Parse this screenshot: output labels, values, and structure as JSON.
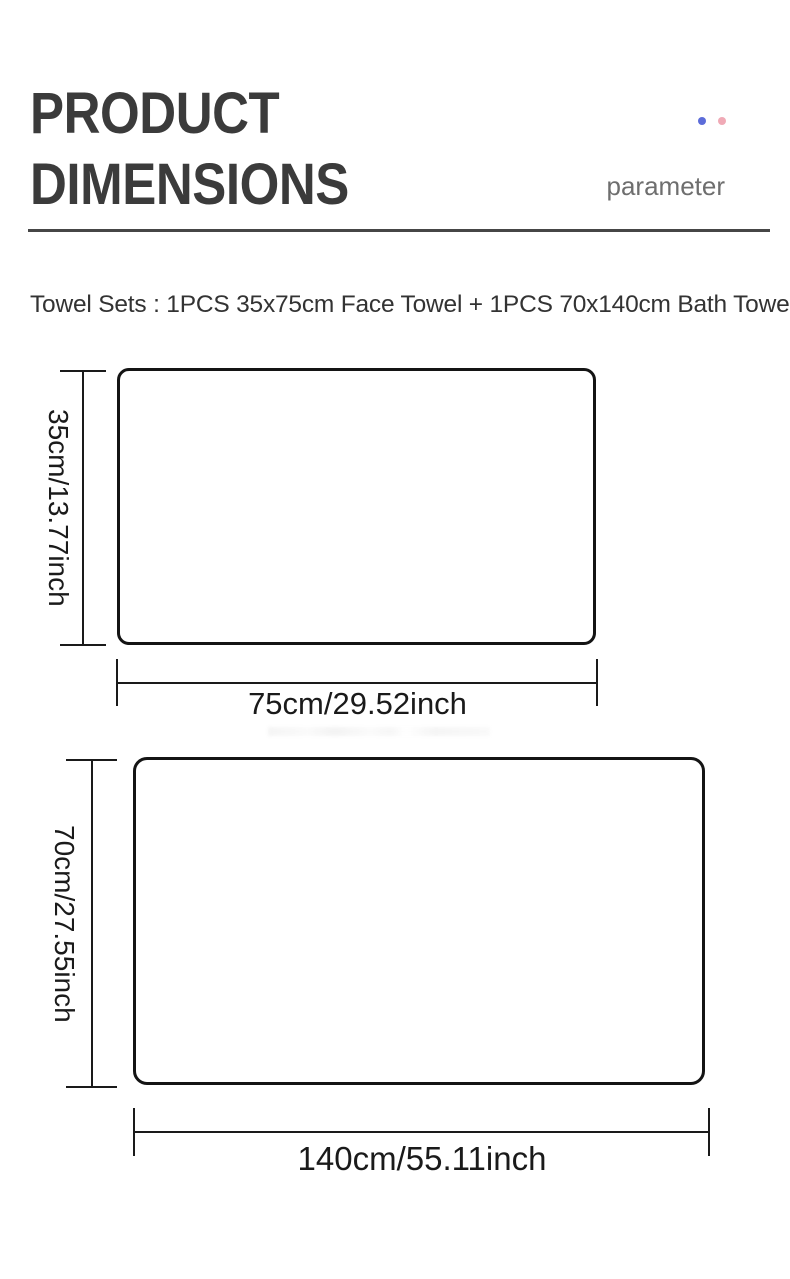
{
  "header": {
    "title_line1": "PRODUCT",
    "title_line2": "DIMENSIONS",
    "parameter_label": "parameter",
    "accent_dot_blue": "#5c6cd9",
    "accent_dot_pink": "#f0aab6"
  },
  "intro": {
    "text": "Towel Sets : 1PCS 35x75cm Face Towel + 1PCS 70x140cm Bath Towel"
  },
  "diagrams": [
    {
      "name": "Face Towel",
      "height_label": "35cm/13.77inch",
      "width_label": "75cm/29.52inch"
    },
    {
      "name": "Bath Towel",
      "height_label": "70cm/27.55inch",
      "width_label": "140cm/55.11inch"
    }
  ],
  "colors": {
    "heading": "#3b3b3b",
    "rule": "#464646",
    "line": "#1a1a1a",
    "background": "#ffffff"
  }
}
